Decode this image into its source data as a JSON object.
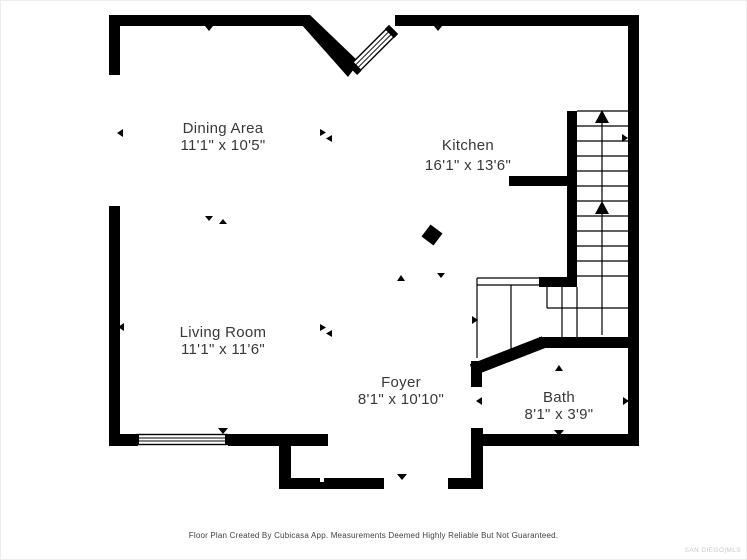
{
  "colors": {
    "background": "#ffffff",
    "wall": "#000000",
    "room-text": "#383838",
    "footer-text": "#3f3f3f",
    "watermark-text": "#c9c9c9"
  },
  "rooms": [
    {
      "id": "dining",
      "name": "Dining Area",
      "dims": "11'1\" x 10'5\""
    },
    {
      "id": "kitchen",
      "name": "Kitchen",
      "dims": "16'1\" x 13'6\""
    },
    {
      "id": "living",
      "name": "Living Room",
      "dims": "11'1\" x 11'6\""
    },
    {
      "id": "foyer",
      "name": "Foyer",
      "dims": "8'1\" x 10'10\""
    },
    {
      "id": "bath",
      "name": "Bath",
      "dims": "8'1\" x 3'9\""
    }
  ],
  "footer": {
    "disclaimer": "Floor Plan Created By Cubicasa App. Measurements Deemed Highly Reliable But Not Guaranteed.",
    "watermark": "SAN DIEGO|MLS"
  }
}
